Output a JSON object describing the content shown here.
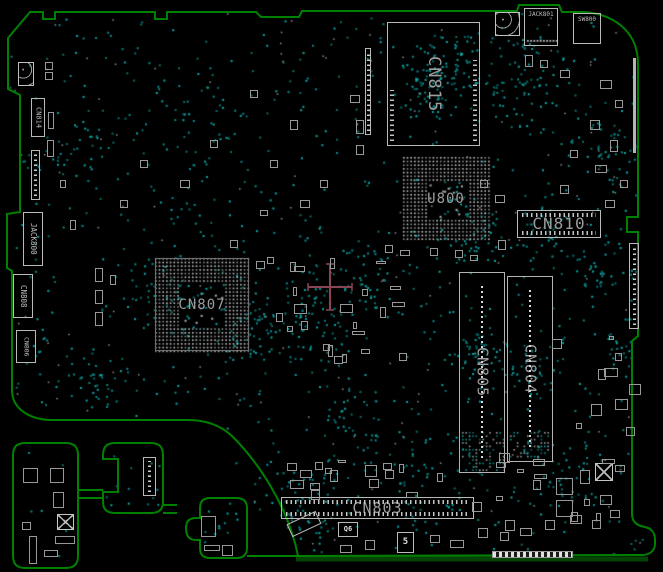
{
  "app": {
    "type": "pcb-boardview",
    "description": "Motherboard component placement view (top side)"
  },
  "board": {
    "background_color": "#000000",
    "outline_color": "#008000",
    "testpoint_color": "#0b8686",
    "component_outline_color": "#b9b9b9",
    "label_color": "#9d9d9d",
    "origin_marker_color": "#8a4455",
    "origin_marker": {
      "x": 330,
      "y": 287
    }
  },
  "components": {
    "labeled": [
      {
        "name": "cn814",
        "ref": "CN814",
        "type": "rect",
        "dir": "v",
        "x": 31,
        "y": 98,
        "w": 14,
        "h": 39,
        "fs": 7
      },
      {
        "name": "jack800",
        "ref": "JACK800",
        "type": "rect",
        "dir": "v",
        "x": 23,
        "y": 212,
        "w": 20,
        "h": 54,
        "fs": 7.5
      },
      {
        "name": "cn808",
        "ref": "CN808",
        "type": "rect",
        "dir": "v",
        "x": 13,
        "y": 274,
        "w": 20,
        "h": 44,
        "fs": 7.5
      },
      {
        "name": "cn806",
        "ref": "CN806",
        "type": "rect",
        "dir": "v",
        "x": 16,
        "y": 330,
        "w": 20,
        "h": 33,
        "fs": 6.5
      },
      {
        "name": "cn815",
        "ref": "CN815",
        "type": "rect",
        "dir": "v",
        "x": 387,
        "y": 22,
        "w": 93,
        "h": 124,
        "fs": 17,
        "pins": "v"
      },
      {
        "name": "u800",
        "ref": "U800",
        "type": "bga",
        "dir": "h",
        "x": 403,
        "y": 157,
        "w": 86,
        "h": 83,
        "fs": 14,
        "border": false
      },
      {
        "name": "cn807",
        "ref": "CN807",
        "type": "bga",
        "dir": "h",
        "x": 155,
        "y": 258,
        "w": 94,
        "h": 93,
        "fs": 14,
        "border": true
      },
      {
        "name": "cn810",
        "ref": "CN810",
        "type": "rect",
        "dir": "h",
        "x": 517,
        "y": 210,
        "w": 84,
        "h": 28,
        "fs": 16,
        "pins": "h"
      },
      {
        "name": "cn805",
        "ref": "CN805",
        "type": "slot",
        "dir": "v",
        "x": 459,
        "y": 272,
        "w": 46,
        "h": 201,
        "fs": 15
      },
      {
        "name": "cn804",
        "ref": "CN804",
        "type": "slot",
        "dir": "v",
        "x": 507,
        "y": 276,
        "w": 46,
        "h": 186,
        "fs": 15
      },
      {
        "name": "cn803",
        "ref": "CN803",
        "type": "rect",
        "dir": "h",
        "x": 281,
        "y": 497,
        "w": 193,
        "h": 22,
        "fs": 15,
        "pins": "h"
      },
      {
        "name": "jack801",
        "ref": "JACK801",
        "type": "rect",
        "dir": "h-top",
        "x": 524,
        "y": 8,
        "w": 34,
        "h": 38,
        "fs": 6
      },
      {
        "name": "sw800",
        "ref": "SW800",
        "type": "rect",
        "dir": "h-top",
        "x": 573,
        "y": 13,
        "w": 28,
        "h": 31,
        "fs": 6
      },
      {
        "name": "q6",
        "ref": "Q6",
        "type": "rect",
        "dir": "h",
        "x": 338,
        "y": 522,
        "w": 20,
        "h": 15,
        "fs": 7,
        "bright": true
      },
      {
        "name": "u5",
        "ref": "5",
        "type": "rect",
        "dir": "h",
        "x": 397,
        "y": 532,
        "w": 17,
        "h": 21,
        "fs": 9,
        "bright": true
      }
    ],
    "unlabeled": [
      {
        "name": "top-left-module",
        "type": "padbox",
        "x": 18,
        "y": 62,
        "w": 16,
        "h": 24
      },
      {
        "name": "corner-module",
        "type": "padbox",
        "x": 495,
        "y": 12,
        "w": 25,
        "h": 24
      },
      {
        "name": "right-edge-strip",
        "type": "bar",
        "x": 633,
        "y": 58,
        "w": 3,
        "h": 95
      },
      {
        "name": "right-edge-connector",
        "type": "connv",
        "x": 629,
        "y": 243,
        "w": 10,
        "h": 86
      },
      {
        "name": "strip-left-of-cn815",
        "type": "connv",
        "x": 365,
        "y": 48,
        "w": 6,
        "h": 87
      },
      {
        "name": "connector-under-cn814",
        "type": "connv",
        "x": 31,
        "y": 150,
        "w": 9,
        "h": 50
      },
      {
        "name": "bottom-edge-connector",
        "type": "striped",
        "x": 492,
        "y": 551,
        "w": 81,
        "h": 7
      },
      {
        "name": "island1-qfn-ic",
        "type": "xbox",
        "x": 57,
        "y": 514,
        "w": 17,
        "h": 16
      },
      {
        "name": "island2-connector",
        "type": "connv",
        "x": 143,
        "y": 457,
        "w": 13,
        "h": 39
      },
      {
        "name": "bottom-right-qfn-ic",
        "type": "xbox",
        "x": 595,
        "y": 463,
        "w": 18,
        "h": 18
      },
      {
        "name": "tilted-component",
        "type": "tilted",
        "x": 288,
        "y": 517,
        "w": 32,
        "h": 14
      }
    ]
  }
}
